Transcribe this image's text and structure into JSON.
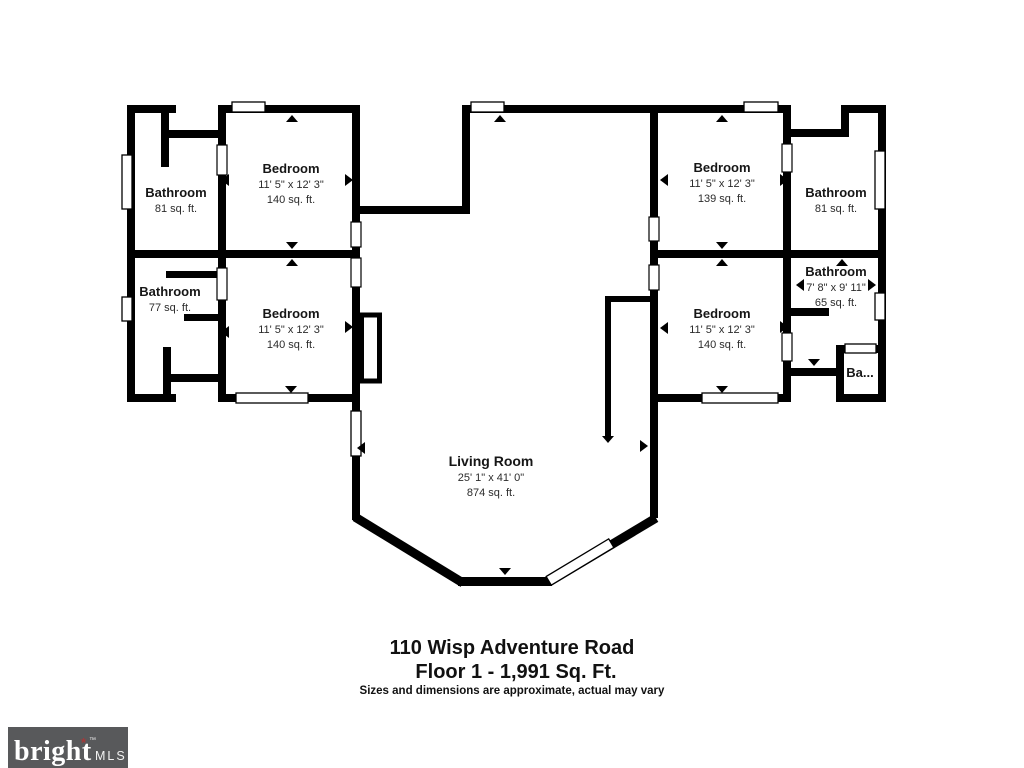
{
  "meta": {
    "address": "110 Wisp Adventure Road",
    "floor_label": "Floor 1 - 1,991 Sq. Ft.",
    "disclaimer": "Sizes and dimensions are approximate, actual may vary"
  },
  "branding": {
    "logo_text": "bright",
    "logo_suffix": "MLS",
    "logo_tm": "™",
    "logo_star": "*",
    "logo_bg": "#58595b",
    "logo_accent": "#a33a3a"
  },
  "colors": {
    "wall": "#000000",
    "background": "#ffffff",
    "label_text": "#161616"
  },
  "rooms": {
    "bathroom_top_left": {
      "name": "Bathroom",
      "area": "81 sq. ft."
    },
    "bedroom_top_left": {
      "name": "Bedroom",
      "dims": "11' 5\" x 12' 3\"",
      "area": "140 sq. ft."
    },
    "bathroom_mid_left": {
      "name": "Bathroom",
      "area": "77 sq. ft."
    },
    "bedroom_bottom_left": {
      "name": "Bedroom",
      "dims": "11' 5\" x 12' 3\"",
      "area": "140 sq. ft."
    },
    "bedroom_top_right": {
      "name": "Bedroom",
      "dims": "11' 5\" x 12' 3\"",
      "area": "139 sq. ft."
    },
    "bathroom_top_right": {
      "name": "Bathroom",
      "area": "81 sq. ft."
    },
    "bathroom_mid_right": {
      "name": "Bathroom",
      "dims": "7' 8\" x 9' 11\"",
      "area": "65 sq. ft."
    },
    "bedroom_bottom_right": {
      "name": "Bedroom",
      "dims": "11' 5\" x 12' 3\"",
      "area": "140 sq. ft."
    },
    "bathroom_small_right": {
      "name": "Ba..."
    },
    "living_room": {
      "name": "Living Room",
      "dims": "25' 1\" x 41' 0\"",
      "area": "874 sq. ft."
    }
  }
}
